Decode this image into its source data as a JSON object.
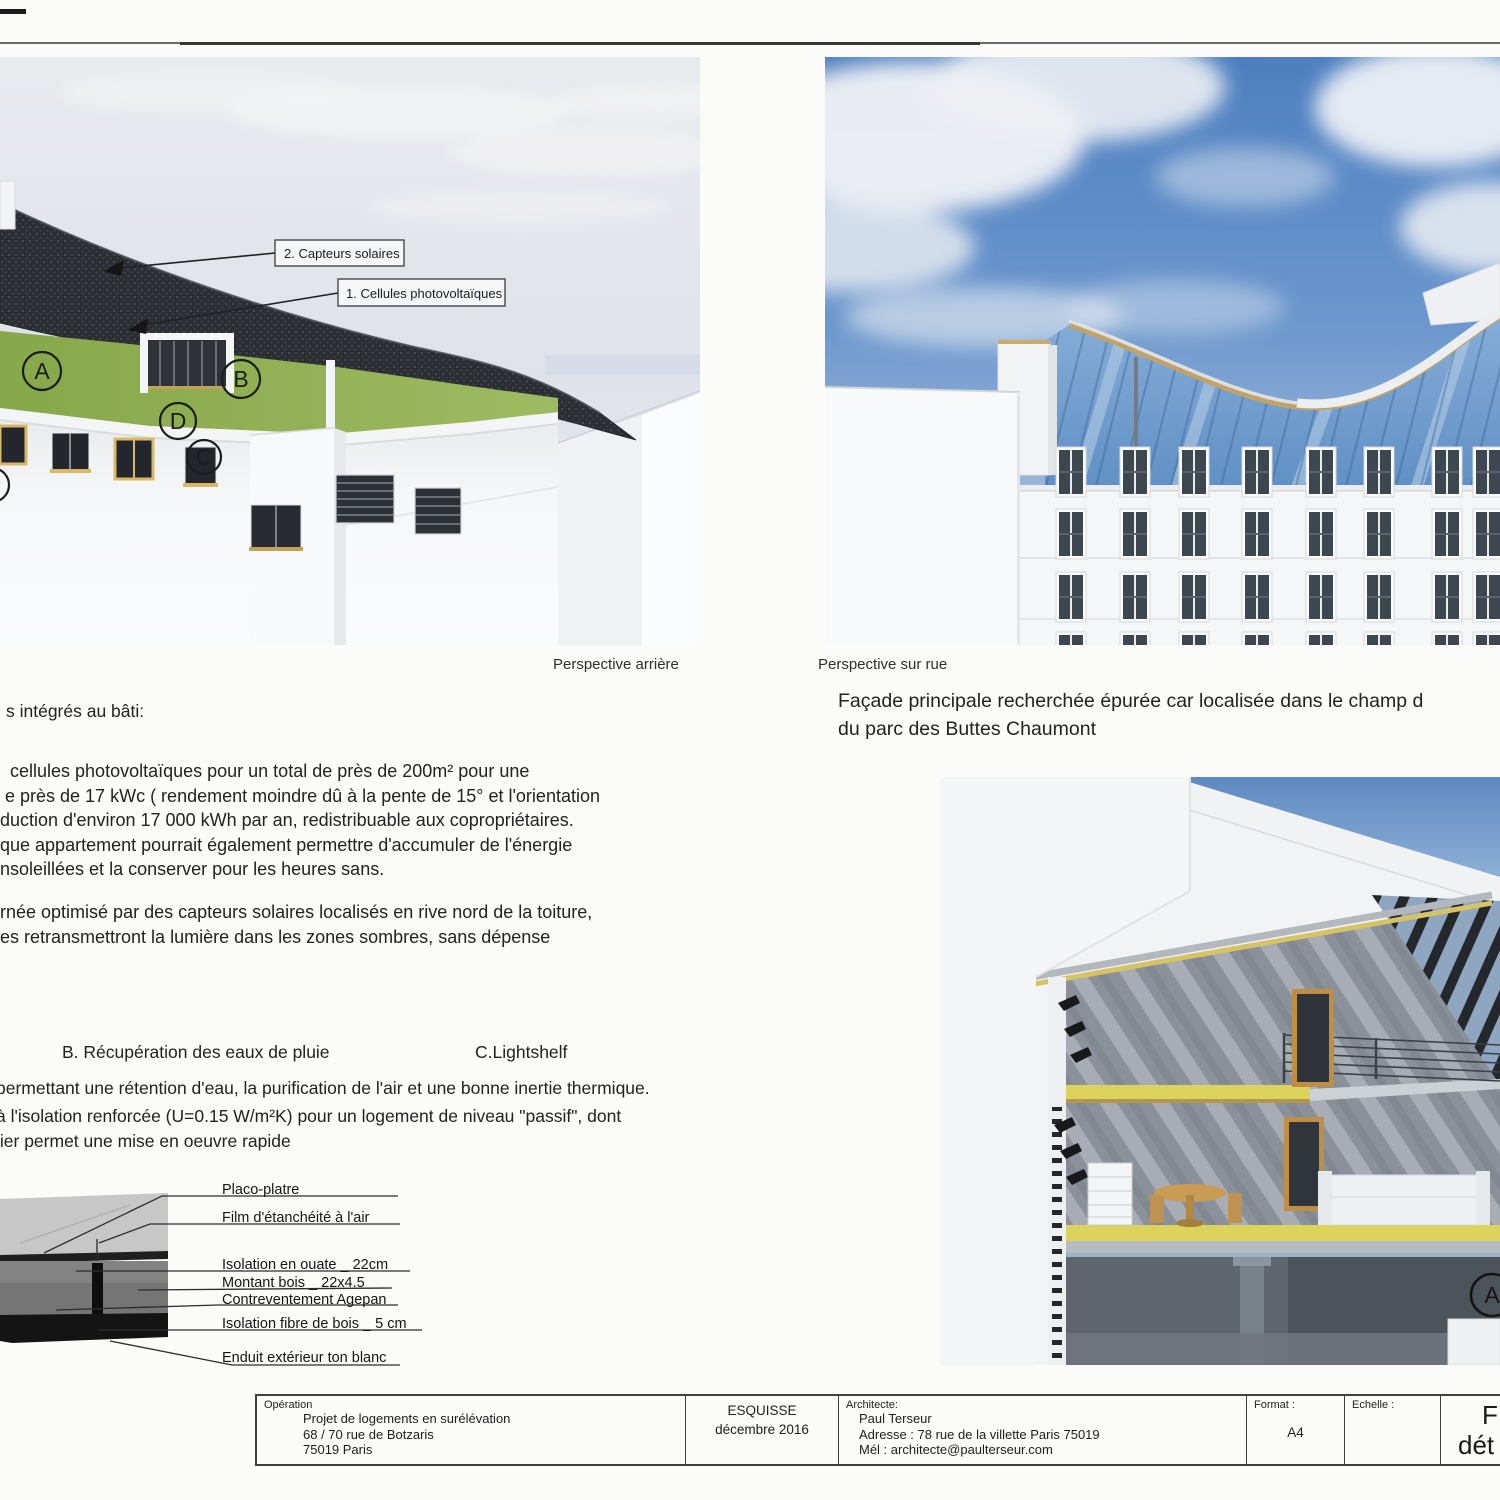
{
  "document": {
    "captions": {
      "left": "Perspective arrière",
      "right": "Perspective sur rue"
    },
    "intro_line": "s intégrés au bâti:",
    "paragraph1": [
      "cellules photovoltaïques pour un total de près de 200m² pour une",
      "e près de 17 kWc ( rendement moindre dû à la pente de 15° et l'orientation",
      "duction d'environ 17 000 kWh par an, redistribuable aux copropriétaires.",
      "que appartement pourrait également permettre d'accumuler de l'énergie",
      "nsoleillées et la conserver pour les heures sans."
    ],
    "paragraph2": [
      "rnée optimisé par des capteurs solaires localisés en rive nord de la toiture,",
      "es retransmettront la lumière dans les zones sombres, sans dépense"
    ],
    "heading_b": "B. Récupération  des eaux de pluie",
    "heading_c": "C.Lightshelf",
    "paragraph3": [
      "permettant une rétention d'eau, la purification de l'air et une bonne inertie thermique.",
      "à l'isolation renforcée (U=0.15 W/m²K) pour un logement de niveau \"passif\", dont",
      "lier permet une mise en oeuvre rapide"
    ],
    "facade_note": [
      "Façade principale recherchée épurée car localisée dans le champ d",
      "du parc des Buttes Chaumont"
    ]
  },
  "left_render": {
    "callout1": "2. Capteurs solaires",
    "callout2": "1. Cellules photovoltaïques",
    "markers": {
      "a": "A",
      "b": "B",
      "c": "C",
      "d": "D"
    }
  },
  "section_render": {
    "marker": "A"
  },
  "detail": {
    "callouts": [
      "Placo-platre",
      "Film d'étanchéité à l'air",
      "Isolation en ouate _ 22cm",
      "Montant bois _ 22x4.5",
      "Contreventement Agepan",
      "Isolation fibre de bois _ 5 cm",
      "Enduit extérieur ton blanc"
    ]
  },
  "titleblock": {
    "operation_label": "Opération",
    "operation_lines": [
      "Projet de logements en surélévation",
      "68 / 70 rue de Botzaris",
      "75019 Paris"
    ],
    "phase": "ESQUISSE",
    "phase_date": "décembre 2016",
    "architect_label": "Architecte:",
    "architect_lines": [
      "Paul  Terseur",
      "Adresse : 78 rue de la villette Paris 75019",
      "Mél : architecte@paulterseur.com"
    ],
    "format_label": "Format :",
    "format_value": "A4",
    "scale_label": "Echelle :",
    "sheet_title_lines": [
      "F",
      "dét"
    ]
  },
  "colors": {
    "roof_dark": "#2b2e33",
    "grass_green": "#93b153",
    "sky_blue": "#4d7fc0",
    "slab_yellow": "#dcd35c",
    "wood_tan": "#c2a266"
  }
}
